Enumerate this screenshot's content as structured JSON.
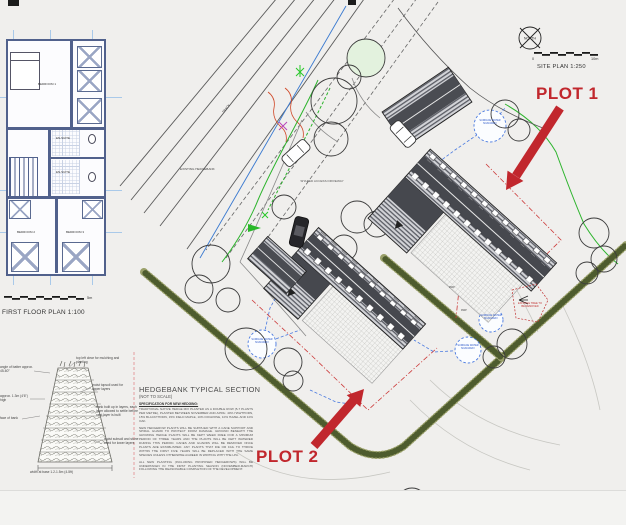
{
  "site_plan": {
    "title": "SITE PLAN 1:250",
    "north_label": "NORTH",
    "scale_zero": "0",
    "scale_end": "10m",
    "plot1": "PLOT 1",
    "plot2": "PLOT 2",
    "labels": {
      "hedgebank": "EXISTING HEDGEBANK",
      "track": "TRACK",
      "driveway": "SHARED ACCESS DRIVEWAY",
      "soakaway": "SURFACE WATER SOAKAWAY",
      "tree_removed": "EXISTING TREE TO BE REMOVED",
      "rwp": "RWP"
    }
  },
  "floor_plan": {
    "title": "FIRST FLOOR PLAN 1:100",
    "scale_end_label": "5m",
    "rooms": {
      "bedroom1": "BEDROOM 1",
      "ensuite1": "EN-SUITE",
      "ensuite2": "EN-SUITE",
      "bedroom2": "BEDROOM 2",
      "bedroom3": "BEDROOM 3"
    }
  },
  "hedgebank_section": {
    "title": "HEDGEBANK TYPICAL SECTION",
    "subtitle": "(NOT TO SCALE)",
    "spec_heading": "SPECIFICATION FOR NEW HEDGING:",
    "paragraphs": [
      "TRADITIONAL NATIVE HEDGE MIX PLANTED AS A DOUBLE ROW (5-7 PLANTS PER METRE), PLANTED BETWEEN NOVEMBER AND APRIL: 40% HAWTHORN, 15% BLACKTHORN, 15% FIELD MAPLE, 10% DOGROSE, 10% HAZEL AND 10% OAK.",
      "NEW HEDGEROW PLANTS WILL BE SUPPLIED WITH A CANE SUPPORT AND SPIRAL GUARD TO PROTECT FROM DAMAGE. GROUND BENEATH THE GROWING HEDGE PLANTS WILL BE KEPT WEED FREE FOR A MINIMUM PERIOD OF THREE YEARS AND THE PLANTS WILL BE KEPT WATERED DURING THIS PERIOD. CANES AND GUARDS WILL BE REMOVED ONCE PLANTS ARE ESTABLISHED. ANY PLANTS THAT DIE OR FAIL TO THRIVE WITHIN THE FIRST FIVE YEARS WILL BE REPLACED WITH THE SAME SPECIES UNLESS OTHERWISE AGREED IN WRITING WITH THE LPA.",
      "ALL NEW PLANTING (INCLUDING PROPOSED HEDGEROWS) WILL BE UNDERTAKEN IN THE FIRST PLANTING SEASON (NOVEMBER-MARCH) FOLLOWING THE REASONABLE COMPLETION OF THE DEVELOPMENT."
    ],
    "annotations": {
      "top": "top left clear for mulching and planting",
      "topsoil": "moist topsoil used for upper layers",
      "layers": "bank built up in layers, each layer allowed to settle before next layer is built",
      "subsoil": "moist subsoil and stone used for lower layers",
      "batter": "angle of batter approx. 45-60°",
      "height": "approx. 1.3m (4'6\") high",
      "face": "face of bank",
      "base": "width at base 1.2-1.5m (4-5ft)"
    }
  }
}
